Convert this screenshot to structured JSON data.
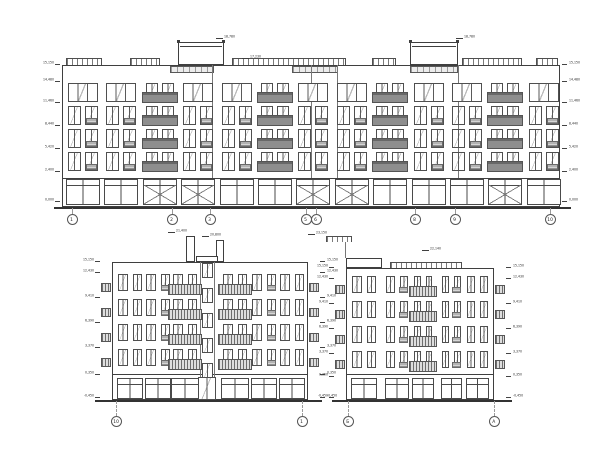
{
  "palette": {
    "paper": "#ffffff",
    "ink": "#3f3f3f",
    "balcony_fill": "#8e8e8e",
    "stripe_rail": "#6e6e6e",
    "leader_gray": "#9a9a9a"
  },
  "elevations": [
    {
      "id": "elevation-top",
      "type": "long",
      "frame": {
        "x": 62,
        "y": 65,
        "w": 498,
        "wall_h": 113,
        "ground_h": 29
      },
      "groundline": {
        "y": 207,
        "x1": 54,
        "x2": 571
      },
      "rows": [
        83,
        106,
        129,
        152
      ],
      "row_h": 20,
      "bays": {
        "xs": [
          68,
          106,
          145,
          183,
          222,
          260,
          298,
          337,
          375,
          414,
          452,
          490,
          529
        ],
        "w": 30,
        "balcony_idx": [
          2,
          5,
          8,
          11
        ]
      },
      "ground_cells": {
        "y": 179,
        "h": 26,
        "x_glass_idx": [
          2,
          3,
          6,
          7,
          11
        ]
      },
      "towers": [
        {
          "x": 178,
          "w": 46,
          "top": 42
        },
        {
          "x": 410,
          "w": 48,
          "top": 42
        }
      ],
      "rails": {
        "y": 58,
        "h": 7,
        "segments": [
          [
            66,
            36
          ],
          [
            130,
            30
          ],
          [
            232,
            114
          ],
          [
            372,
            24
          ],
          [
            462,
            60
          ],
          [
            536,
            22
          ]
        ]
      },
      "hatch_bands": {
        "y": 66,
        "h": 7,
        "segments": [
          [
            170,
            44
          ],
          [
            292,
            46
          ],
          [
            410,
            48
          ]
        ]
      },
      "joints": [
        212,
        311,
        337,
        458
      ],
      "marks_left": {
        "x": 60,
        "items": [
          {
            "y": 64,
            "t": "15,150"
          },
          {
            "y": 81,
            "t": "14,480"
          },
          {
            "y": 102,
            "t": "11,460"
          },
          {
            "y": 125,
            "t": "8,440"
          },
          {
            "y": 148,
            "t": "5,420"
          },
          {
            "y": 171,
            "t": "2,400"
          },
          {
            "y": 201,
            "t": "0,000"
          }
        ]
      },
      "marks_right": {
        "x": 562,
        "items": [
          {
            "y": 64,
            "t": "15,150"
          },
          {
            "y": 81,
            "t": "14,480"
          },
          {
            "y": 102,
            "t": "11,460"
          },
          {
            "y": 125,
            "t": "8,440"
          },
          {
            "y": 148,
            "t": "5,420"
          },
          {
            "y": 171,
            "t": "2,400"
          },
          {
            "y": 201,
            "t": "0,000"
          }
        ]
      },
      "roof_marks": [
        {
          "x": 224,
          "y": 35,
          "t": "18,780"
        },
        {
          "x": 464,
          "y": 35,
          "t": "18,780"
        },
        {
          "x": 250,
          "y": 55,
          "t": "17,230"
        }
      ],
      "axes": {
        "y": 214,
        "items": [
          {
            "x": 72,
            "label": "1"
          },
          {
            "x": 172,
            "label": "2"
          },
          {
            "x": 210,
            "label": "3"
          },
          {
            "x": 306,
            "label": "5"
          },
          {
            "x": 316,
            "label": "6"
          },
          {
            "x": 415,
            "label": "8"
          },
          {
            "x": 455,
            "label": "9"
          },
          {
            "x": 550,
            "label": "10"
          }
        ]
      }
    },
    {
      "id": "elevation-bottom-left",
      "type": "small",
      "frame": {
        "x": 112,
        "y": 262,
        "w": 196,
        "h": 138
      },
      "groundline": {
        "y": 400,
        "x1": 95,
        "x2": 322
      },
      "ground_sep": 374,
      "rows": [
        274,
        299,
        324,
        349
      ],
      "row_h": 21,
      "bays": [
        {
          "x": 118,
          "w": 24,
          "t": "pair"
        },
        {
          "x": 146,
          "w": 24,
          "t": "pairg"
        },
        {
          "x": 172,
          "w": 26,
          "t": "sbal"
        },
        {
          "x": 222,
          "w": 26,
          "t": "sbal"
        },
        {
          "x": 252,
          "w": 24,
          "t": "pairg"
        },
        {
          "x": 280,
          "w": 24,
          "t": "pair"
        }
      ],
      "stair": {
        "x": 200,
        "w": 14,
        "win_ys": [
          263,
          288,
          313,
          338,
          363
        ],
        "win_h": 15,
        "door": {
          "x": 198,
          "w": 18,
          "y": 377,
          "h": 23
        },
        "cap": {
          "x": 196,
          "w": 22,
          "y": 256,
          "h": 6
        }
      },
      "tabs": {
        "left_x": 101,
        "right_x": 309,
        "w": 10,
        "h": 9,
        "dy": 9
      },
      "vents": [
        {
          "x": 186,
          "w": 9,
          "top": 236
        },
        {
          "x": 216,
          "w": 8,
          "top": 240
        }
      ],
      "ground": {
        "y": 378,
        "h": 21
      },
      "marks_left": {
        "x": 100,
        "items": [
          {
            "y": 261,
            "t": "15,150"
          },
          {
            "y": 272,
            "t": "12,430"
          },
          {
            "y": 297,
            "t": "9,410"
          },
          {
            "y": 322,
            "t": "6,390"
          },
          {
            "y": 347,
            "t": "3,370"
          },
          {
            "y": 374,
            "t": "0,350"
          },
          {
            "y": 397,
            "t": "-0,450"
          }
        ]
      },
      "marks_right": {
        "x": 320,
        "items": [
          {
            "y": 261,
            "t": "15,150"
          },
          {
            "y": 272,
            "t": "12,430"
          },
          {
            "y": 297,
            "t": "9,410"
          },
          {
            "y": 322,
            "t": "6,390"
          },
          {
            "y": 347,
            "t": "3,370"
          },
          {
            "y": 374,
            "t": "0,350"
          },
          {
            "y": 397,
            "t": "-0,450"
          }
        ]
      },
      "roof_marks": [
        {
          "x": 176,
          "y": 229,
          "t": "21,400"
        },
        {
          "x": 210,
          "y": 233,
          "t": "20,800"
        }
      ],
      "axes": {
        "y": 416,
        "items": [
          {
            "x": 116,
            "label": "10"
          },
          {
            "x": 302,
            "label": "1"
          }
        ]
      }
    },
    {
      "id": "elevation-bottom-right",
      "type": "small",
      "frame": {
        "x": 346,
        "y": 268,
        "w": 148,
        "h": 132
      },
      "groundline": {
        "y": 400,
        "x1": 332,
        "x2": 512
      },
      "ground_sep": 374,
      "rows": [
        276,
        301,
        326,
        351
      ],
      "row_h": 21,
      "bays": [
        {
          "x": 352,
          "w": 24,
          "t": "pair"
        },
        {
          "x": 386,
          "w": 22,
          "t": "pairg"
        },
        {
          "x": 413,
          "w": 20,
          "t": "sbal"
        },
        {
          "x": 442,
          "w": 19,
          "t": "pairg"
        },
        {
          "x": 467,
          "w": 21,
          "t": "pair"
        }
      ],
      "raised": {
        "x": 346,
        "w": 36,
        "y": 258,
        "h": 10
      },
      "roof_rail": {
        "x": 390,
        "w": 72,
        "y": 262,
        "h": 6
      },
      "stack": {
        "x": 326,
        "w": 26,
        "y": 236,
        "h": 6,
        "drop_x": 345,
        "drop_y": 242,
        "drop_h": 16
      },
      "tabs": {
        "left_x": 335,
        "right_x": 495,
        "w": 10,
        "h": 9,
        "dy": 9
      },
      "ground": {
        "y": 378,
        "h": 21
      },
      "marks_left": {
        "x": 334,
        "items": [
          {
            "y": 267,
            "t": "15,150"
          },
          {
            "y": 278,
            "t": "12,430"
          },
          {
            "y": 303,
            "t": "9,410"
          },
          {
            "y": 328,
            "t": "6,390"
          },
          {
            "y": 353,
            "t": "3,370"
          },
          {
            "y": 376,
            "t": "0,350"
          },
          {
            "y": 397,
            "t": "-0,450"
          }
        ]
      },
      "marks_right": {
        "x": 506,
        "items": [
          {
            "y": 267,
            "t": "15,150"
          },
          {
            "y": 278,
            "t": "12,430"
          },
          {
            "y": 303,
            "t": "9,410"
          },
          {
            "y": 328,
            "t": "6,390"
          },
          {
            "y": 353,
            "t": "3,370"
          },
          {
            "y": 376,
            "t": "0,350"
          },
          {
            "y": 397,
            "t": "-0,450"
          }
        ]
      },
      "roof_marks": [
        {
          "x": 430,
          "y": 247,
          "t": "22,140"
        },
        {
          "x": 316,
          "y": 231,
          "t": "23,150"
        }
      ],
      "axes": {
        "y": 416,
        "items": [
          {
            "x": 348,
            "label": "Б"
          },
          {
            "x": 494,
            "label": "А"
          }
        ]
      }
    }
  ]
}
